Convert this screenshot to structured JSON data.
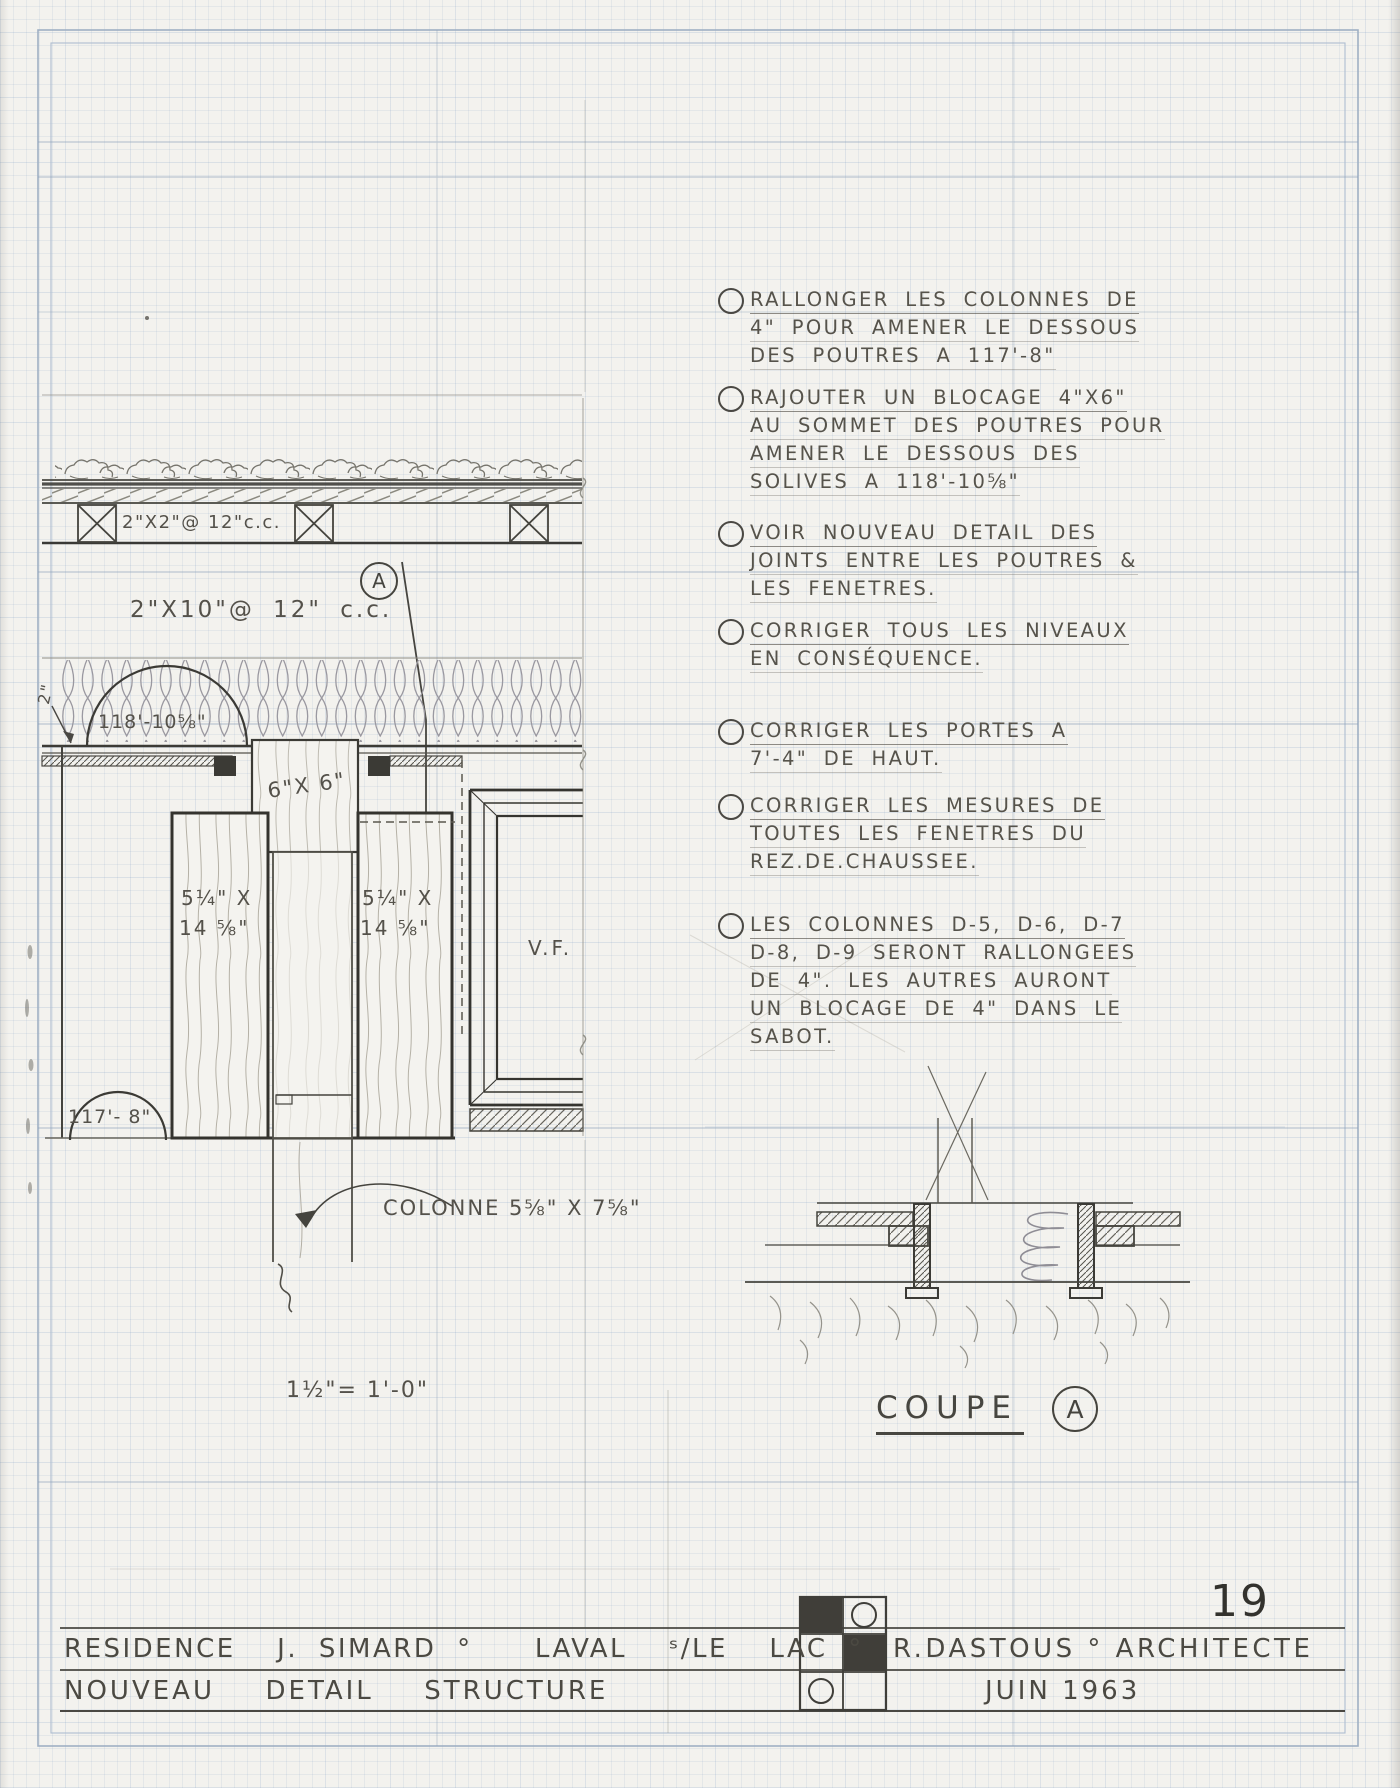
{
  "colors": {
    "pencil": "#4a4842",
    "grid_blue": "#9db4cf",
    "paper": "#f3f2ee"
  },
  "sheet": {
    "number": "19",
    "scale": "1½\"= 1'-0\""
  },
  "section": {
    "labels": {
      "strapping": "2\"X2\"@ 12\"c.c.",
      "joists": "2\"X10\"@ 12\" c.c.",
      "marker": "A",
      "level_top": "118'-10⅝\"",
      "offset": "2\"",
      "blocking": "6\"X 6\"",
      "window": "V.F.",
      "level_bottom": "117'- 8\"",
      "column": "COLONNE 5⅝\" X 7⅝\""
    },
    "beam_left": [
      "5¼\" X",
      "14 ⅝\""
    ],
    "beam_right": [
      "5¼\" X",
      "14 ⅝\""
    ]
  },
  "notes": [
    {
      "lines": [
        "RALLONGER LES COLONNES DE",
        "4\" POUR AMENER LE DESSOUS",
        "DES POUTRES A 117'-8\""
      ]
    },
    {
      "lines": [
        "RAJOUTER UN BLOCAGE 4\"X6\"",
        "AU SOMMET DES POUTRES POUR",
        "AMENER LE DESSOUS DES",
        "SOLIVES A 118'-10⅝\""
      ]
    },
    {
      "lines": [
        "VOIR NOUVEAU DETAIL DES",
        "JOINTS ENTRE LES POUTRES &",
        "LES FENETRES."
      ]
    },
    {
      "lines": [
        "CORRIGER TOUS LES NIVEAUX",
        "EN CONSÉQUENCE."
      ]
    },
    {
      "lines": [
        "CORRIGER LES PORTES A",
        "7'-4\" DE HAUT."
      ]
    },
    {
      "lines": [
        "CORRIGER LES MESURES DE",
        "TOUTES LES FENETRES DU",
        "REZ.DE.CHAUSSEE."
      ]
    },
    {
      "lines": [
        "LES COLONNES D-5, D-6, D-7",
        "D-8, D-9 SERONT RALLONGEES",
        "DE 4\". LES AUTRES AURONT",
        "UN BLOCAGE DE 4\" DANS LE",
        "SABOT."
      ]
    }
  ],
  "coupe": {
    "title": "COUPE",
    "marker": "A"
  },
  "title_block": {
    "project": "RESIDENCE  J. SIMARD °   LAVAL  ˢ/LE  LAC °",
    "architect": "R.DASTOUS ° ARCHITECTE",
    "sheet_title": "NOUVEAU  DETAIL  STRUCTURE",
    "date": "JUIN 1963"
  }
}
